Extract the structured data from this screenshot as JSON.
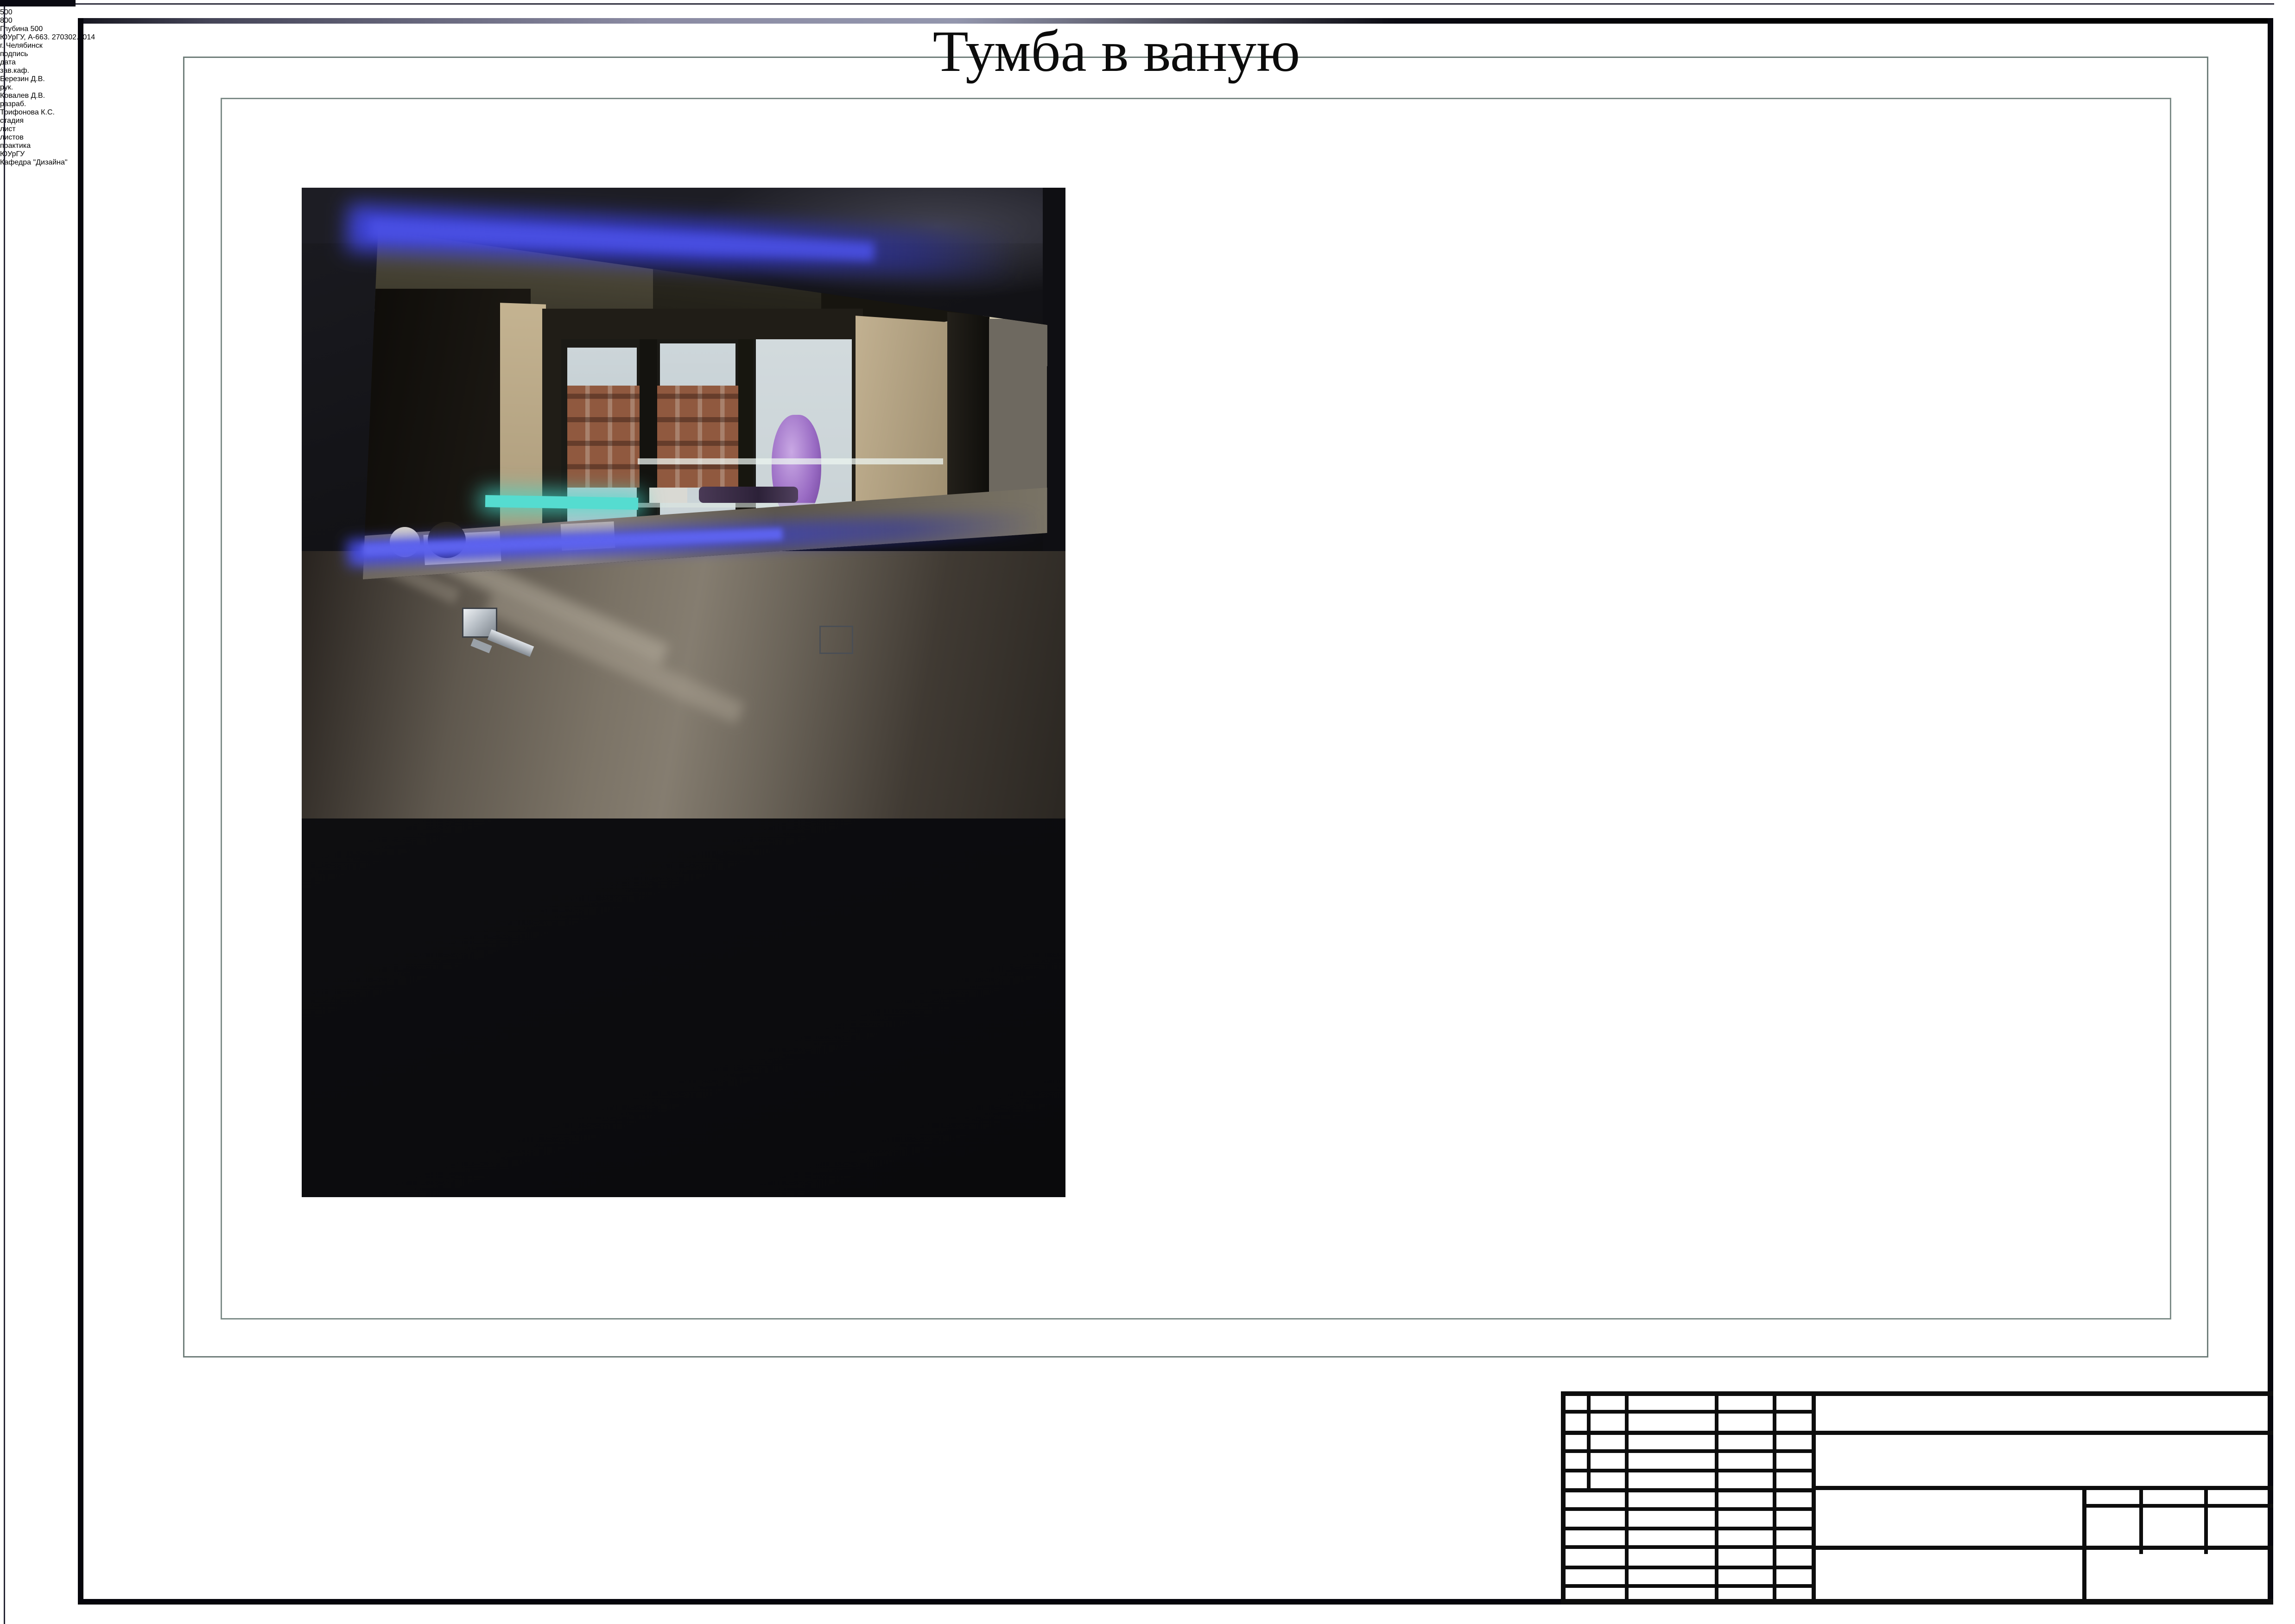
{
  "sheet": {
    "title": "Тумба в ваную"
  },
  "drawing": {
    "height_dim": "560",
    "left_section_dim": "500",
    "right_section_dim": "800",
    "depth_label": "Глубина 500"
  },
  "title_block": {
    "doc_code": "ЮУрГУ, А-663. 270302.2014",
    "city": "г. Челябинск",
    "signature_label": "подпись",
    "date_label": "дата",
    "sign_rows": [
      {
        "role": "зав.каф.",
        "name": "Березин Д.В."
      },
      {
        "role": "рук.",
        "name": "Ковалев Д.В."
      },
      {
        "role": "разраб.",
        "name": "Трифонова К.С."
      }
    ],
    "stage_label": "стадия",
    "sheet_label": "лист",
    "sheets_label": "листов",
    "stage_value": "практика",
    "org": "ЮУрГУ",
    "department": "Кафедра \"Дизайна\""
  },
  "colors": {
    "led_blue": "#4a50e4",
    "wood_brown": "#5e3d16",
    "counter_wood": "#84562a",
    "outline": "#131313",
    "dim_gray": "#9aa3a1",
    "frame_gray": "#6f7e7a"
  }
}
